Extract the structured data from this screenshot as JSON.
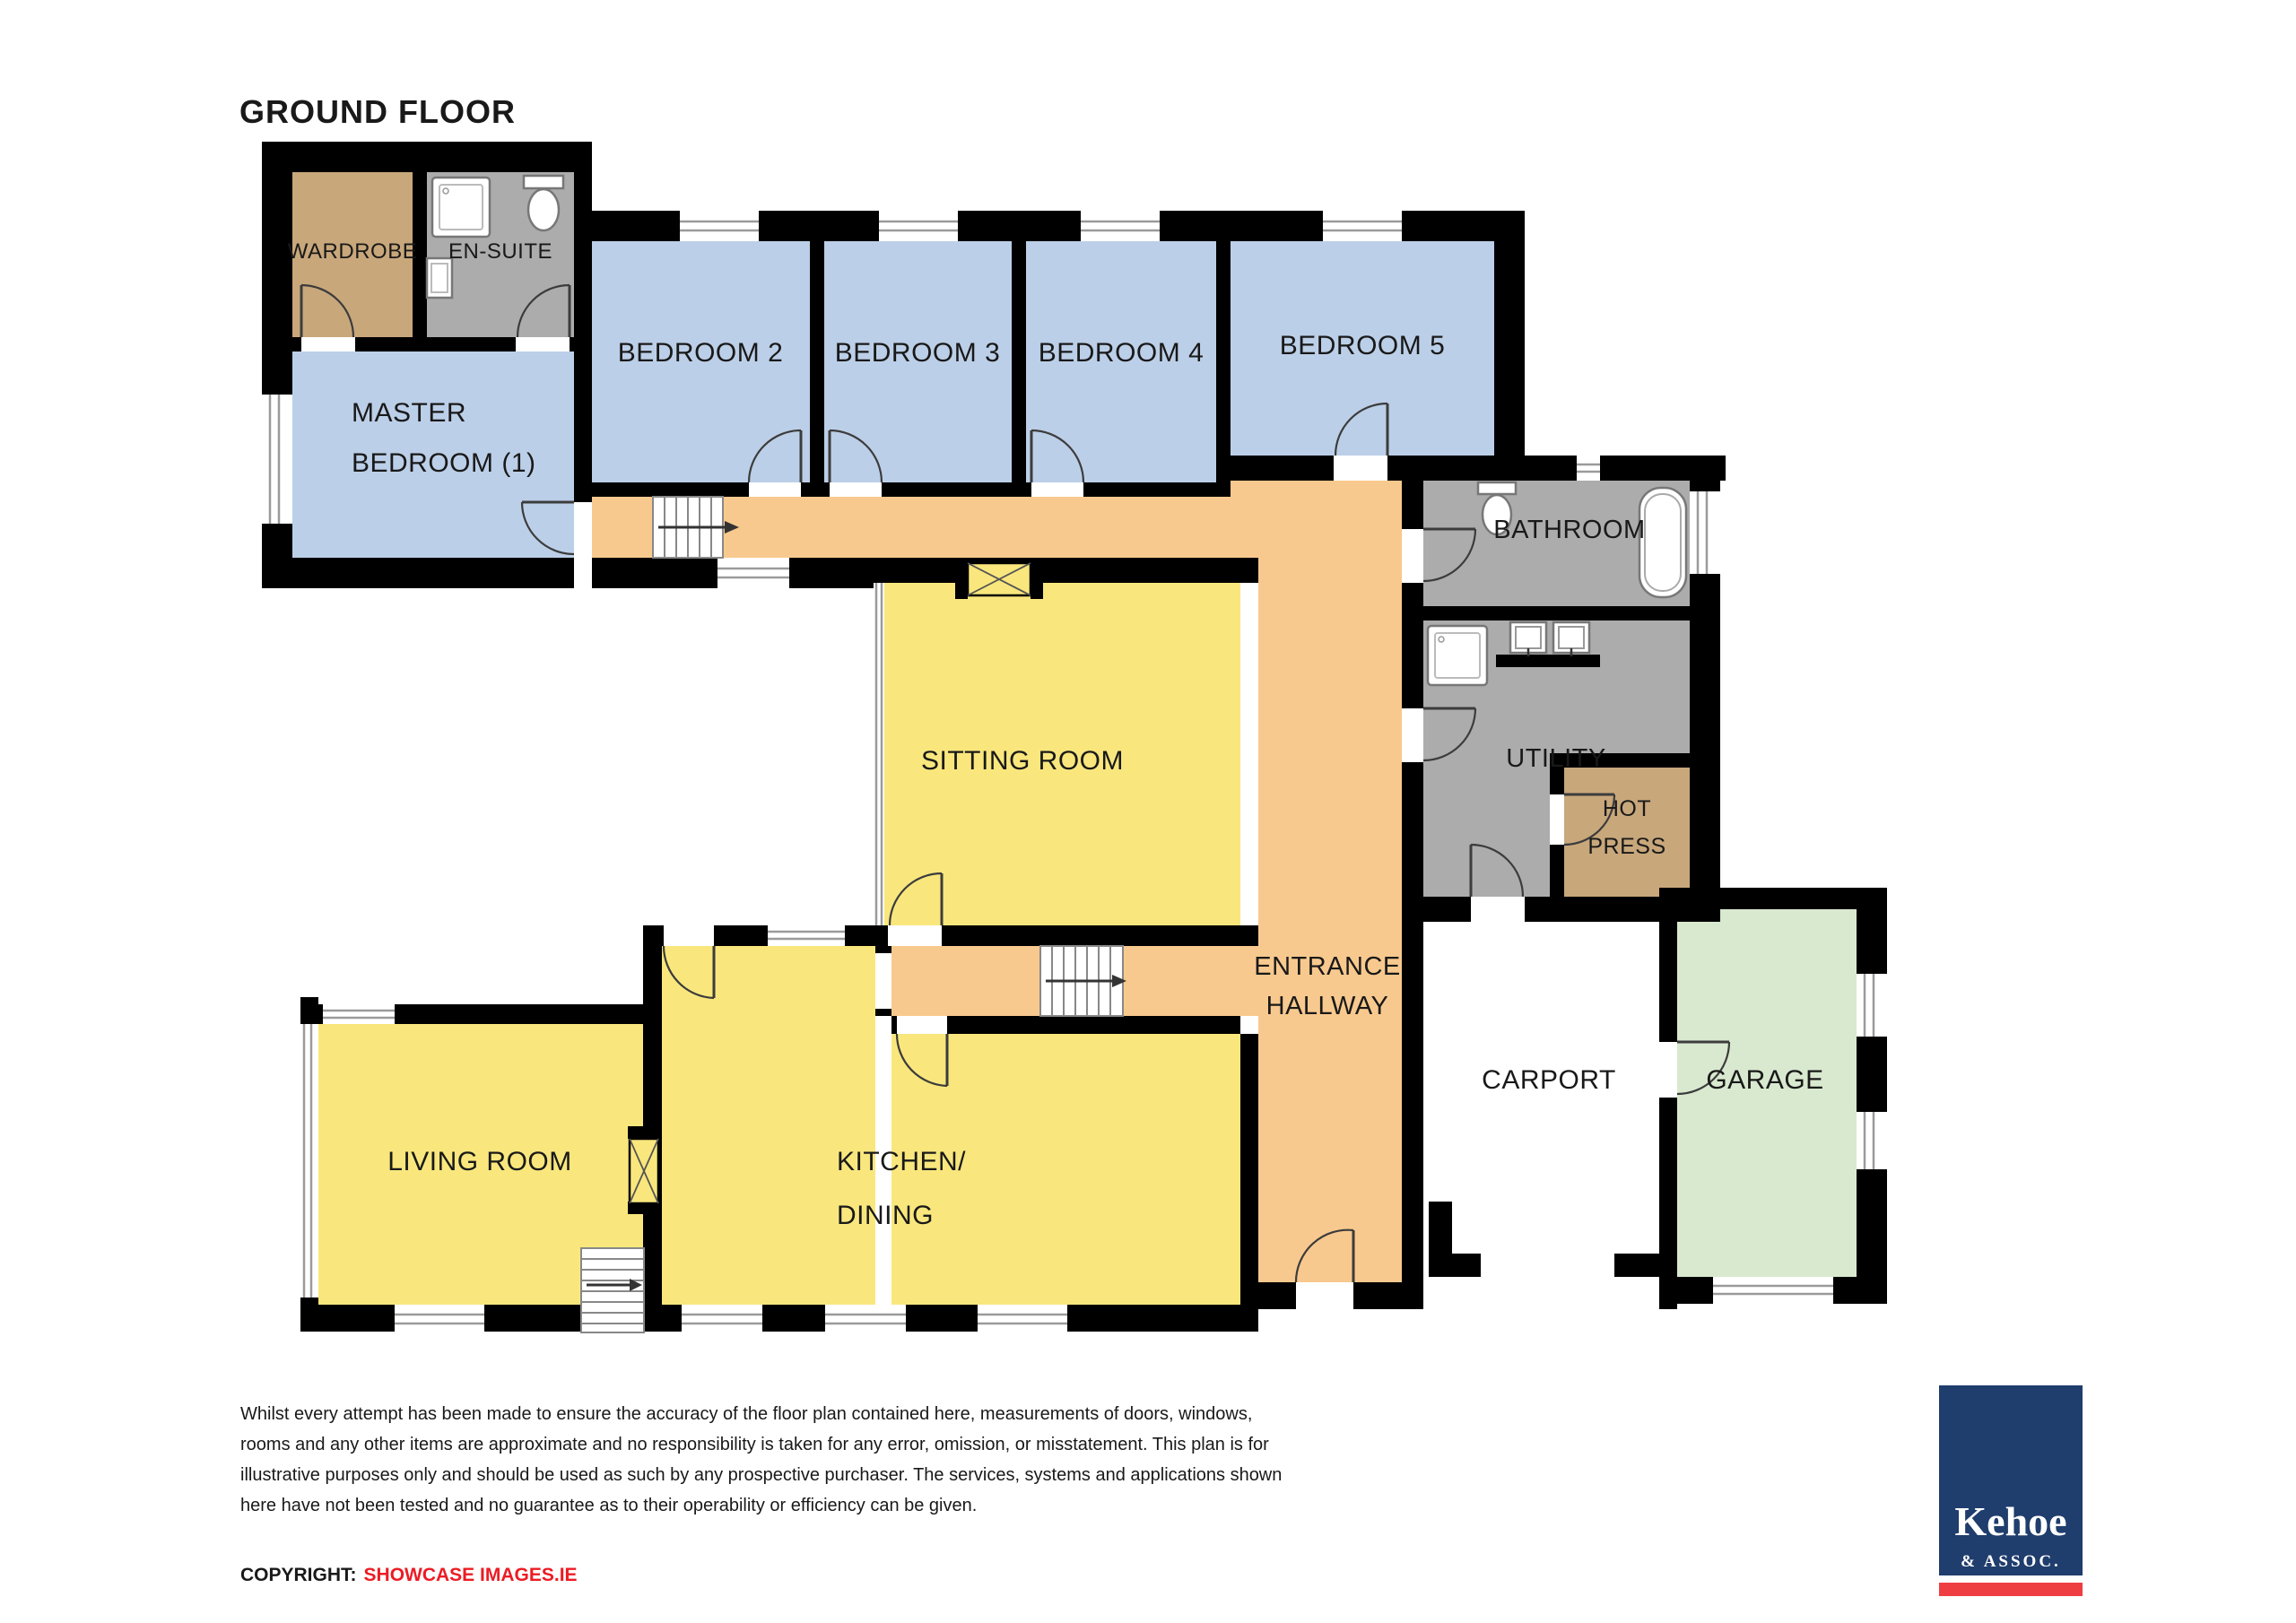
{
  "title": "GROUND FLOOR",
  "rooms": {
    "wardrobe": {
      "label": "WARDROBE"
    },
    "ensuite": {
      "label": "EN-SUITE"
    },
    "master": {
      "line1": "MASTER",
      "line2": "BEDROOM (1)"
    },
    "bedroom2": {
      "label": "BEDROOM 2"
    },
    "bedroom3": {
      "label": "BEDROOM 3"
    },
    "bedroom4": {
      "label": "BEDROOM 4"
    },
    "bedroom5": {
      "label": "BEDROOM 5"
    },
    "bathroom": {
      "label": "BATHROOM"
    },
    "utility": {
      "label": "UTILITY"
    },
    "hot_press": {
      "line1": "HOT",
      "line2": "PRESS"
    },
    "sitting": {
      "label": "SITTING ROOM"
    },
    "entrance": {
      "line1": "ENTRANCE",
      "line2": "HALLWAY"
    },
    "kitchen": {
      "line1": "KITCHEN/",
      "line2": "DINING"
    },
    "living": {
      "label": "LIVING ROOM"
    },
    "carport": {
      "label": "CARPORT"
    },
    "garage": {
      "label": "GARAGE"
    }
  },
  "colors": {
    "bedroom_blue": "#BCCFE8",
    "hallway_orange": "#F8C98E",
    "living_yellow": "#F9E77D",
    "wet_gray": "#ACACAC",
    "storage_tan": "#C8A77B",
    "garage_green": "#D9E9CF",
    "wall_black": "#000000",
    "logo_blue": "#1F3D6D",
    "logo_red": "#EF3E42",
    "copyright_red": "#EC1C24"
  },
  "footer": {
    "disclaimer_lines": [
      "Whilst every attempt has been made to ensure the accuracy of the floor plan contained here, measurements of doors, windows,",
      "rooms and any other items are approximate and no responsibility is taken for any error, omission, or misstatement.  This plan is for",
      "illustrative purposes only and should be used as such by any prospective purchaser.  The services, systems and applications shown",
      "here have not been tested and no guarantee as to their operability or efficiency can be given."
    ],
    "copyright_label": "COPYRIGHT:",
    "copyright_source": "SHOWCASE IMAGES.IE"
  },
  "logo": {
    "name": "Kehoe",
    "suffix": "& ASSOC."
  }
}
